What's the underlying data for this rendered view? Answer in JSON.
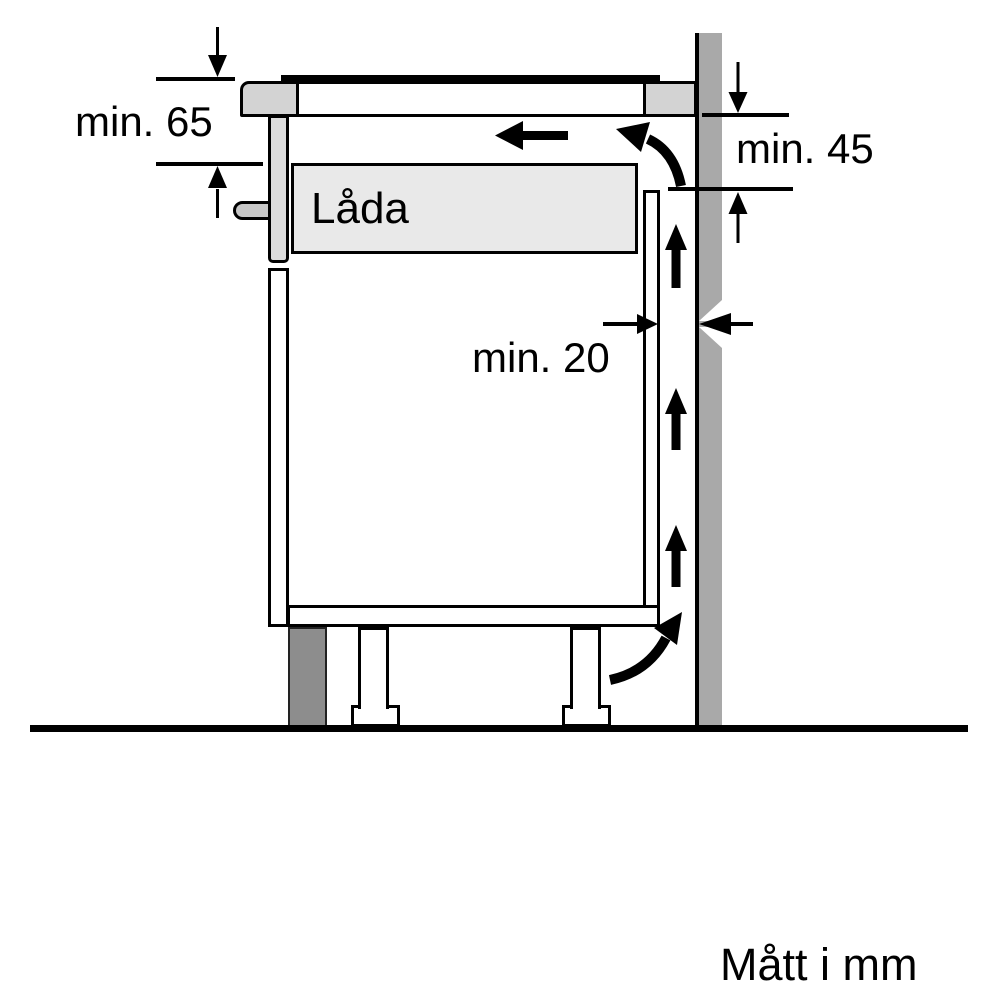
{
  "diagram": {
    "labels": {
      "drawer": "Låda",
      "units_note": "Mått i mm"
    },
    "dimensions": [
      {
        "id": "worktop-to-drawer-clearance",
        "label": "min. 65"
      },
      {
        "id": "worktop-to-backpanel-outlet",
        "label": "min. 45"
      },
      {
        "id": "cabinet-to-wall-gap",
        "label": "min. 20"
      }
    ],
    "colors": {
      "line": "#000000",
      "worktop_section": "#d3d3d3",
      "drawer_fill": "#e9e9e9",
      "drawer_front": "#dcdcdc",
      "handle": "#c7c7c7",
      "wall": "#a9a9a9",
      "plinth": "#8d8d8d",
      "background": "#ffffff"
    }
  }
}
